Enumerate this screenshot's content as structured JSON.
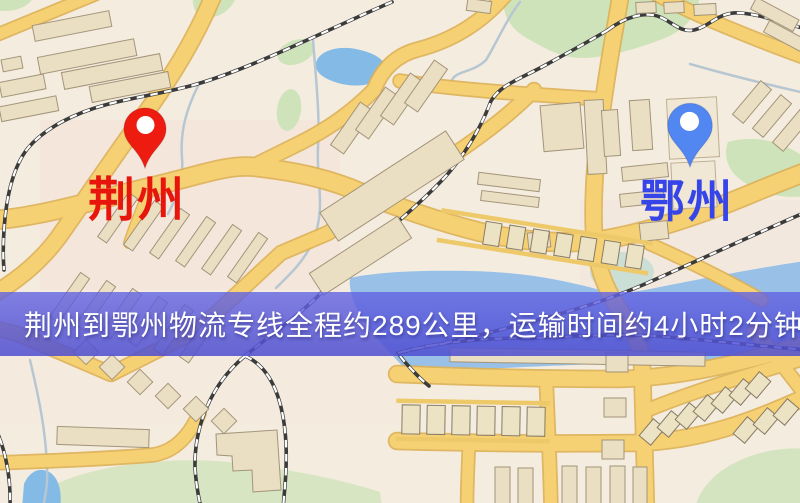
{
  "map": {
    "type": "static-route-map",
    "markers": [
      {
        "id": "origin",
        "label": "荆州",
        "pin_color": "#ee1c10",
        "label_color": "#e8150d",
        "icon": "map-pin-icon"
      },
      {
        "id": "destination",
        "label": "鄂州",
        "pin_color": "#5287f2",
        "label_color": "#3645e8",
        "icon": "map-pin-icon"
      }
    ],
    "banner": {
      "text": "荆州到鄂州物流专线全程约289公里，运输时间约4小时2分钟.",
      "bg_color": "#5c5cd8",
      "text_color": "#ffffff"
    },
    "route": {
      "origin": "荆州",
      "destination": "鄂州",
      "distance_text": "约289公里",
      "duration_text": "约4小时2分钟"
    },
    "colors": {
      "background": "#f4ecdf",
      "road": "#f6d173",
      "road_casing": "#ddb155",
      "water": "#93bfe8",
      "park": "#cfe3bb",
      "railway": "#3b3b3b",
      "building": "#eadfc2"
    }
  }
}
